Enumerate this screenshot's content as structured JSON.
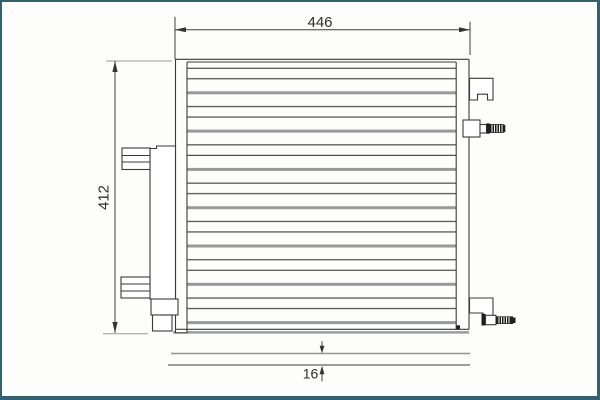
{
  "drawing": {
    "kind": "condenser-technical-drawing",
    "dimensions": {
      "width_label": "446",
      "height_label": "412",
      "depth_label": "16"
    },
    "colors": {
      "frame_border": "#35606e",
      "background": "#fdfdfc",
      "line_dark": "#3a3a3a",
      "line_gray": "#97999b",
      "thread_fill": "#1f1f1f",
      "text": "#2e2e2e"
    }
  }
}
